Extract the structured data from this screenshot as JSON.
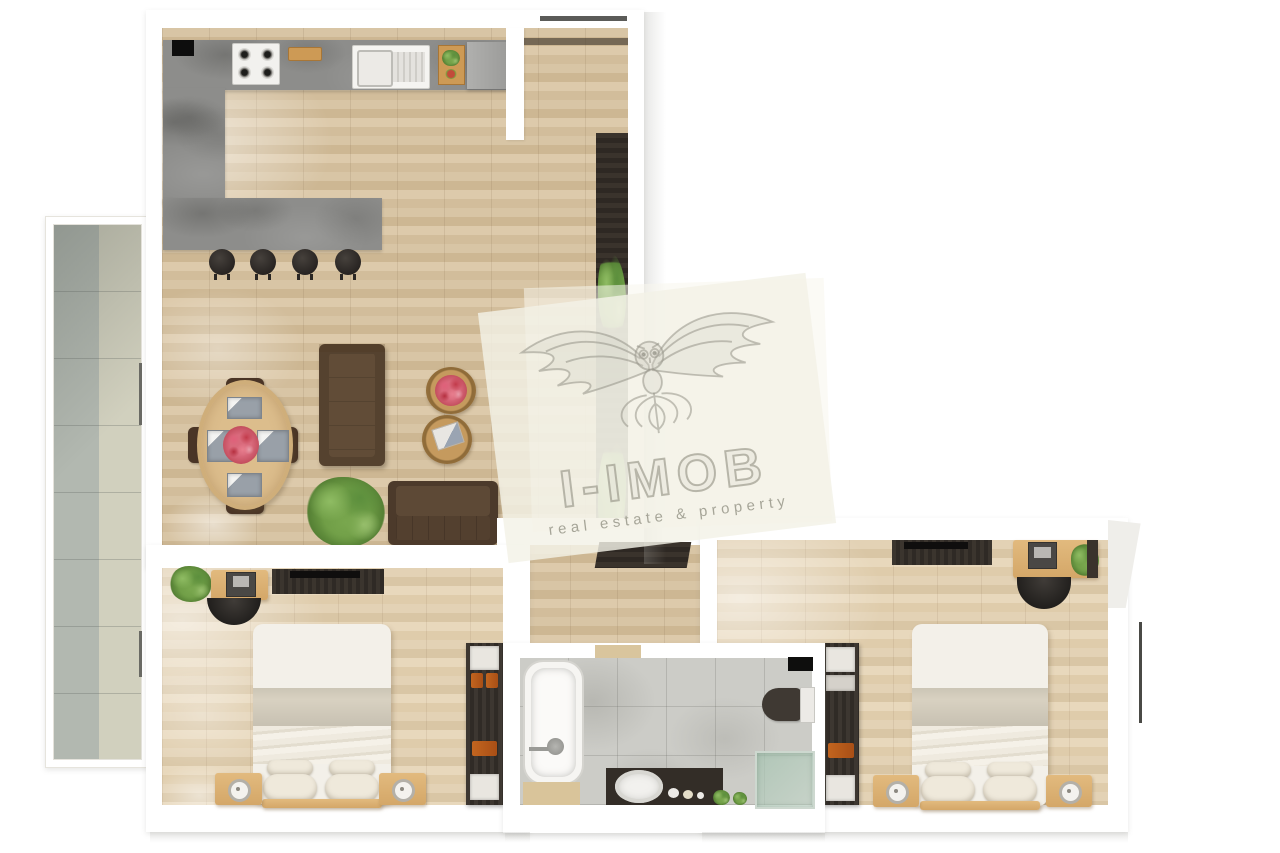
{
  "watermark": {
    "title": "I-IMOB",
    "tagline": "real estate & property",
    "logo_icon": "eagle-owl-crest-icon",
    "overlay_color": "#f2f0e6"
  },
  "palette": {
    "background": "#ffffff",
    "wall": "#ffffff",
    "wood_floor": "#d6c3a3",
    "bedroom_floor": "#e0cfb2",
    "concrete_counter": "#8d8d8b",
    "balcony_tile_gray": "#b4bab2",
    "balcony_tile_beige": "#d2d1bf",
    "bathroom_tile": "#cbcbc7",
    "dark_furniture": "#332d27",
    "sofa_brown": "#55422f",
    "oak_furniture": "#ddb475",
    "bedding_white": "#f3f0e9",
    "blanket_beige": "#d8d1c1",
    "accent_orange": "#b95c20",
    "plant_green": "#79a74e",
    "glass_green": "#afc9b8"
  },
  "floor_plan": {
    "type": "apartment-top-view-render",
    "rooms": [
      {
        "name": "living-room-kitchen",
        "features": [
          "kitchen-counter",
          "gas-hob",
          "cutting-board",
          "kitchen-sink",
          "serving-board",
          "kitchen-cabinet",
          "breakfast-bar",
          "bar-stool",
          "bar-stool",
          "bar-stool",
          "bar-stool",
          "dining-table",
          "dining-chair",
          "dining-chair",
          "dining-chair",
          "dining-chair",
          "place-setting",
          "flower-centerpiece",
          "sofa",
          "loveseat",
          "coffee-table",
          "coffee-table",
          "potted-plant",
          "media-wall"
        ]
      },
      {
        "name": "balcony",
        "features": [
          "tiled-floor",
          "door-handle",
          "door-handle"
        ]
      },
      {
        "name": "hallway",
        "features": [
          "media-cabinet"
        ]
      },
      {
        "name": "bedroom-left",
        "features": [
          "desk",
          "laptop",
          "desk-chair",
          "tv-console",
          "double-bed",
          "pillows",
          "nightstand",
          "nightstand",
          "table-lamp",
          "table-lamp",
          "wardrobe",
          "potted-plant"
        ]
      },
      {
        "name": "bathroom",
        "features": [
          "bathtub",
          "vanity-counter",
          "washbasin",
          "soap-dishes",
          "toilet",
          "shower-cabin",
          "window",
          "potted-plant",
          "potted-plant"
        ]
      },
      {
        "name": "bedroom-right",
        "features": [
          "desk",
          "laptop",
          "desk-chair",
          "tv-console",
          "double-bed",
          "pillows",
          "nightstand",
          "nightstand",
          "table-lamp",
          "table-lamp",
          "wardrobe",
          "potted-plant"
        ]
      }
    ]
  }
}
